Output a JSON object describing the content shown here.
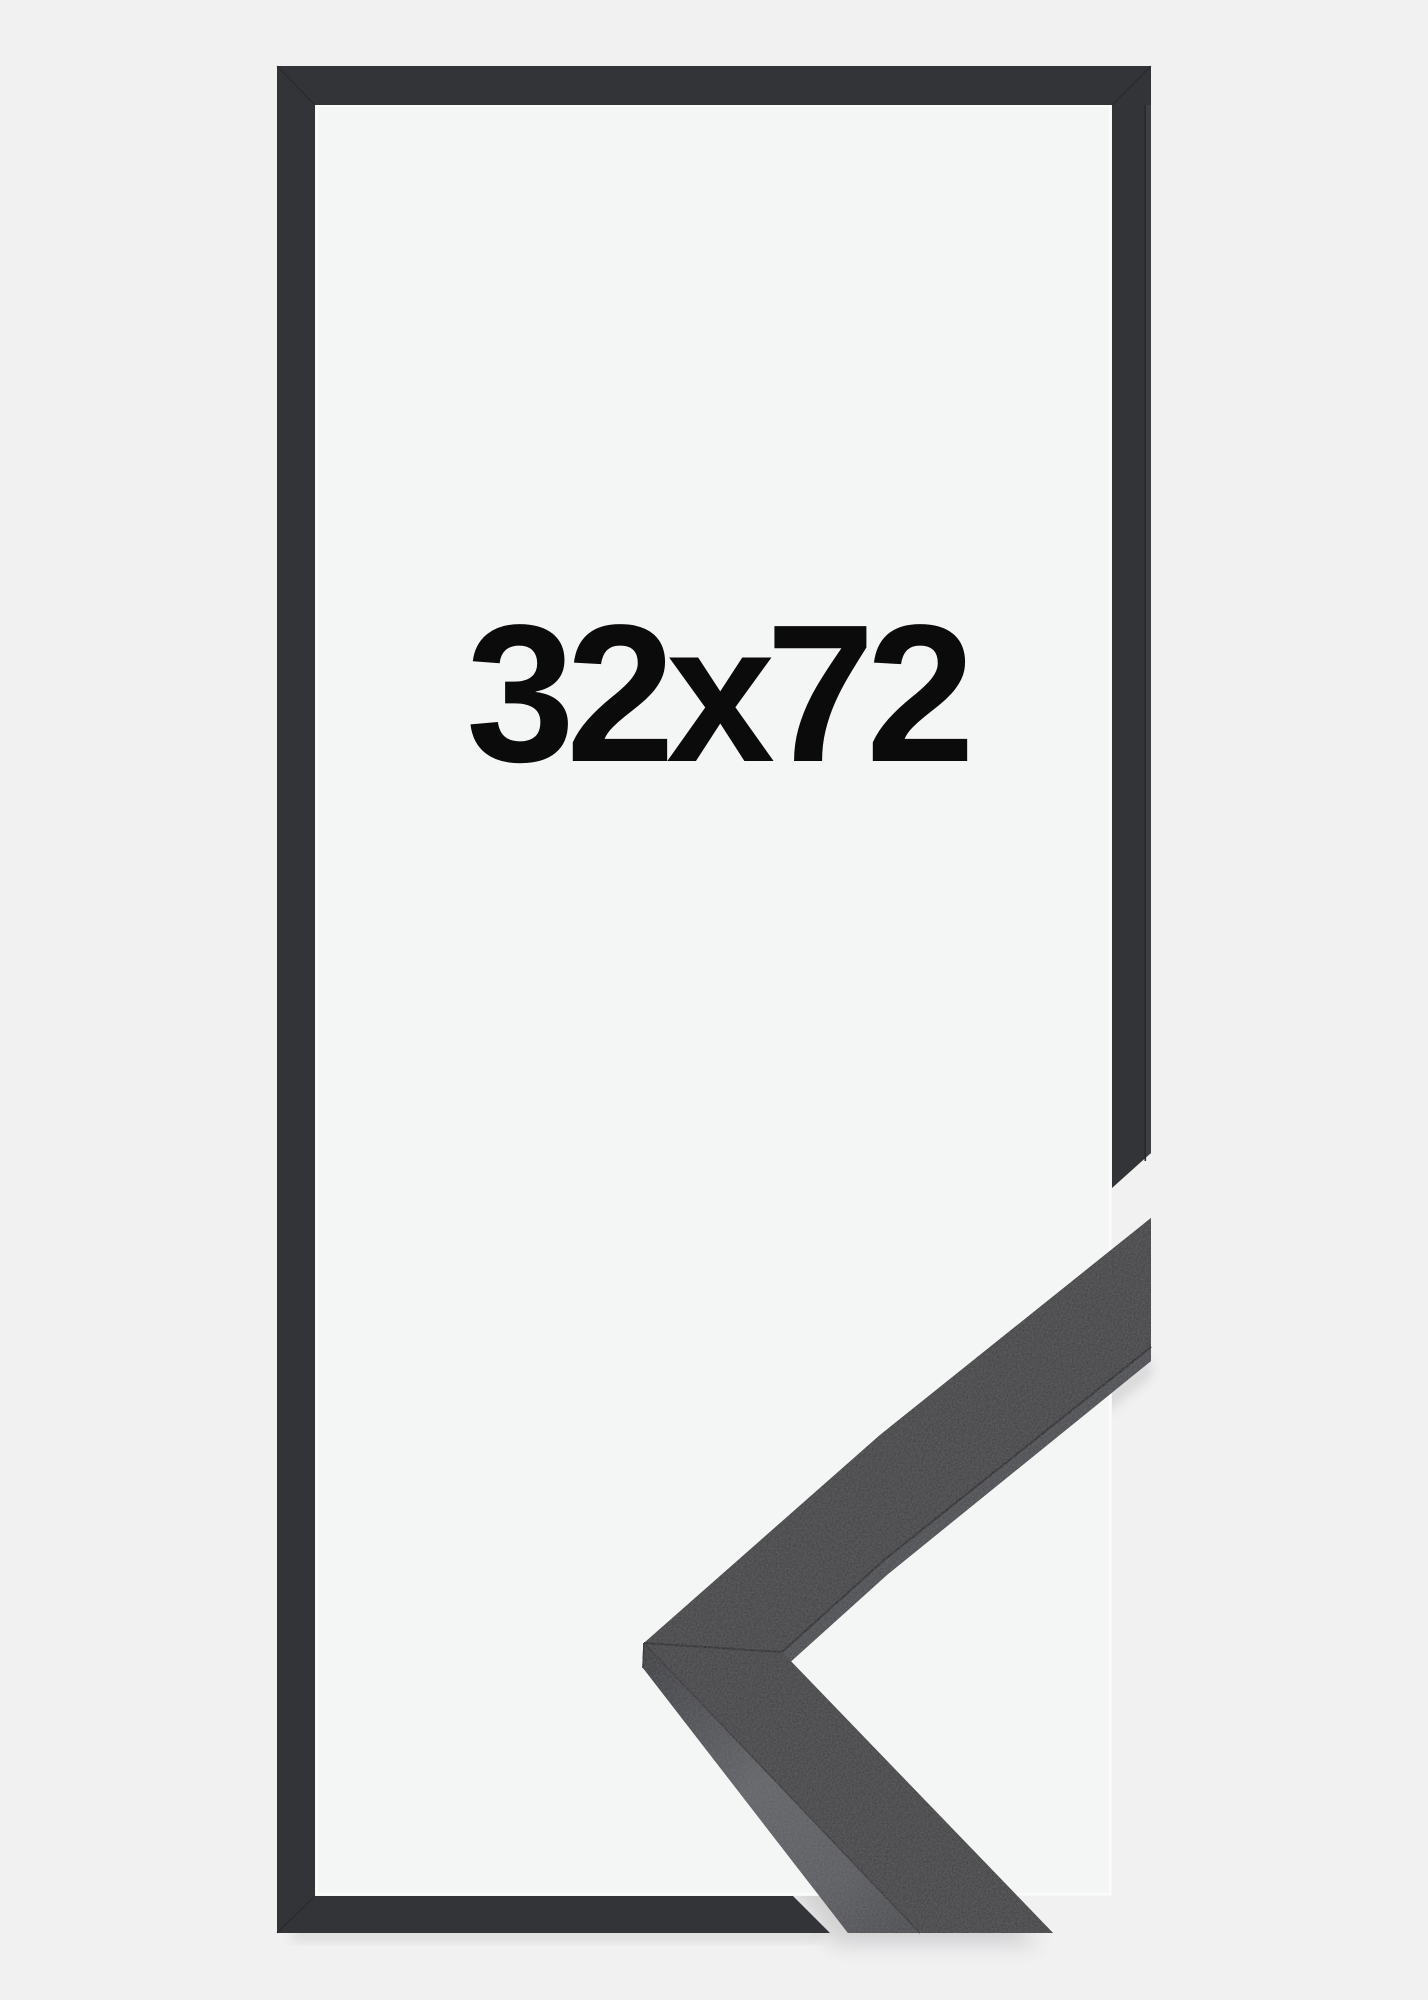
{
  "product": {
    "size_label": "32x72",
    "colors": {
      "background": "#f1f1f2",
      "frame": "#333437",
      "frame_outer_sliver": "#3e3f43",
      "frame_seam": "#27282b",
      "interior": "#f4f5f5",
      "interior_highlight": "#fbfbfc",
      "sample_face": "#3d3d3f",
      "sample_side_strip": "#47484c",
      "sample_seam": "#1d1e21",
      "label_text": "#0b0b0c"
    }
  }
}
